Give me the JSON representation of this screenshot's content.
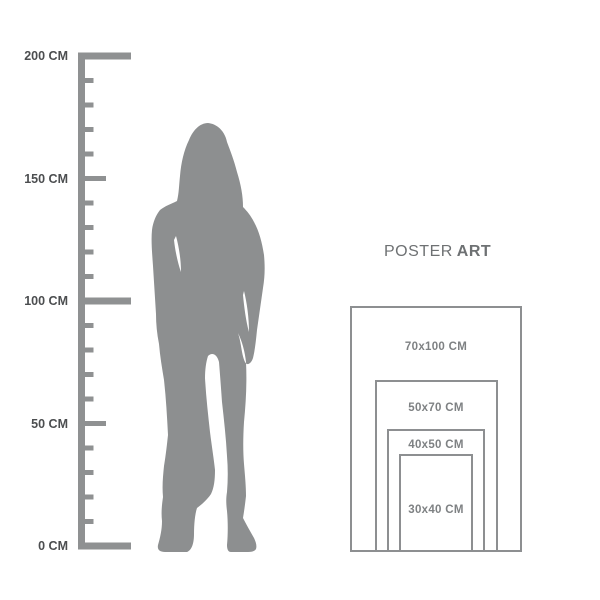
{
  "colors": {
    "silhouette": "#8d8f90",
    "ruler": "#8f9192",
    "ruler_label": "#4c4e50",
    "diagram_border": "#8d8f91",
    "diagram_label": "#7e8183",
    "title": "#6e7173"
  },
  "ruler": {
    "unit": "CM",
    "max_cm": 200,
    "labels": [
      {
        "text": "200 CM",
        "cm": 200
      },
      {
        "text": "150 CM",
        "cm": 150
      },
      {
        "text": "100 CM",
        "cm": 100
      },
      {
        "text": "50 CM",
        "cm": 50
      },
      {
        "text": "0 CM",
        "cm": 0
      }
    ]
  },
  "figure": {
    "icon": "standing-woman-silhouette",
    "approx_height_cm": 173
  },
  "poster_diagram": {
    "title_regular": "POSTER",
    "title_bold": "ART",
    "sizes": [
      {
        "label": "70x100 CM",
        "width_cm": 70,
        "height_cm": 100
      },
      {
        "label": "50x70 CM",
        "width_cm": 50,
        "height_cm": 70
      },
      {
        "label": "40x50 CM",
        "width_cm": 40,
        "height_cm": 50
      },
      {
        "label": "30x40 CM",
        "width_cm": 30,
        "height_cm": 40
      }
    ]
  }
}
